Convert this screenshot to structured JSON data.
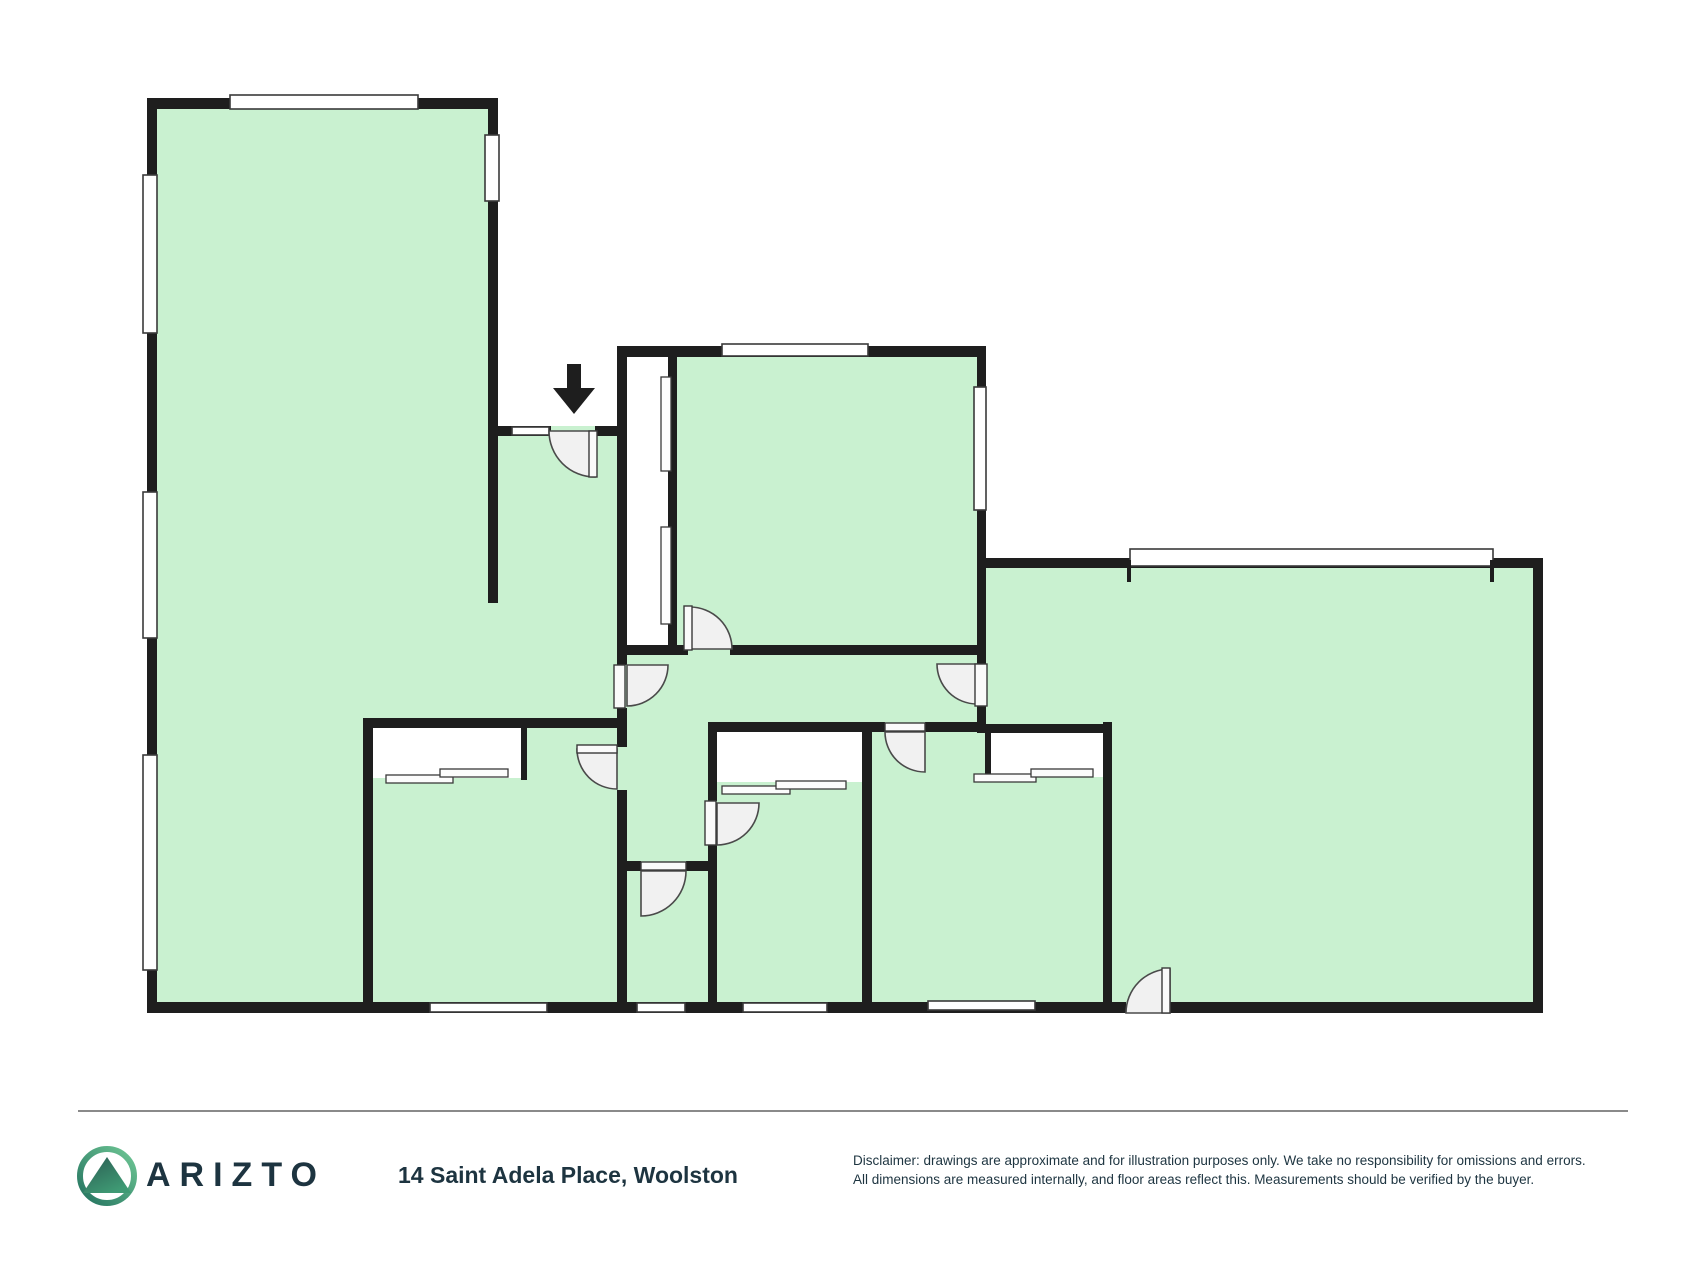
{
  "plan": {
    "type": "floor-plan",
    "room_fill_color": "#c9f1d0",
    "wall_color": "#1e1e1e",
    "door_swing_color": "#f1f1f1",
    "window_color": "#ffffff",
    "icons": [
      "entry-arrow-icon"
    ]
  },
  "footer": {
    "logo_icon": "arizto-mountain-logo-icon",
    "brand": "ARIZTO",
    "address": "14 Saint Adela Place, Woolston",
    "disclaimer_line1": "Disclaimer: drawings are approximate and for illustration purposes only. We take no responsibility for omissions and errors.",
    "disclaimer_line2": "All dimensions are measured internally, and floor areas reflect this. Measurements should be verified by the buyer."
  }
}
